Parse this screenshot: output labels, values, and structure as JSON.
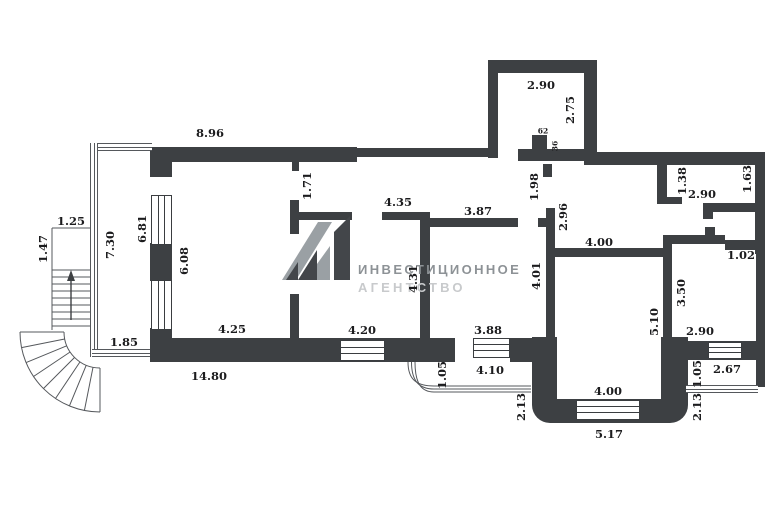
{
  "plan_type": "floor-plan",
  "colors": {
    "wall": "#3d4043",
    "line": "#55585c",
    "label": "#1c1c1e",
    "watermark_primary": "#8d9296",
    "watermark_secondary": "#c8cacc"
  },
  "watermark": {
    "monogram": "А1",
    "line1": "ИНВЕСТИЦИОННОЕ",
    "line2": "АГЕНТСТВО"
  },
  "dims": {
    "d_8_96": "8.96",
    "d_2_90_top": "2.90",
    "d_2_75": "2.75",
    "d_62": "62",
    "d_36": "36",
    "d_1_25": "1.25",
    "d_1_47": "1.47",
    "d_7_30": "7.30",
    "d_6_81": "6.81",
    "d_6_08": "6.08",
    "d_1_85": "1.85",
    "d_14_80": "14.80",
    "d_4_25": "4.25",
    "d_1_71": "1.71",
    "d_4_35": "4.35",
    "d_4_20": "4.20",
    "d_4_31": "4.31",
    "d_3_87": "3.87",
    "d_1_98": "1.98",
    "d_2_96": "2.96",
    "d_3_88": "3.88",
    "d_4_10": "4.10",
    "d_4_01": "4.01",
    "d_1_05_center": "1.05",
    "d_2_13_center": "2.13",
    "d_4_00_room": "4.00",
    "d_4_00_terrace": "4.00",
    "d_5_17": "5.17",
    "d_5_10": "5.10",
    "d_3_50": "3.50",
    "d_1_38": "1.38",
    "d_1_63": "1.63",
    "d_2_90_closet": "2.90",
    "d_1_02": "1.02",
    "d_2_90_br": "2.90",
    "d_2_67": "2.67",
    "d_1_05_right": "1.05",
    "d_2_13_right": "2.13"
  }
}
